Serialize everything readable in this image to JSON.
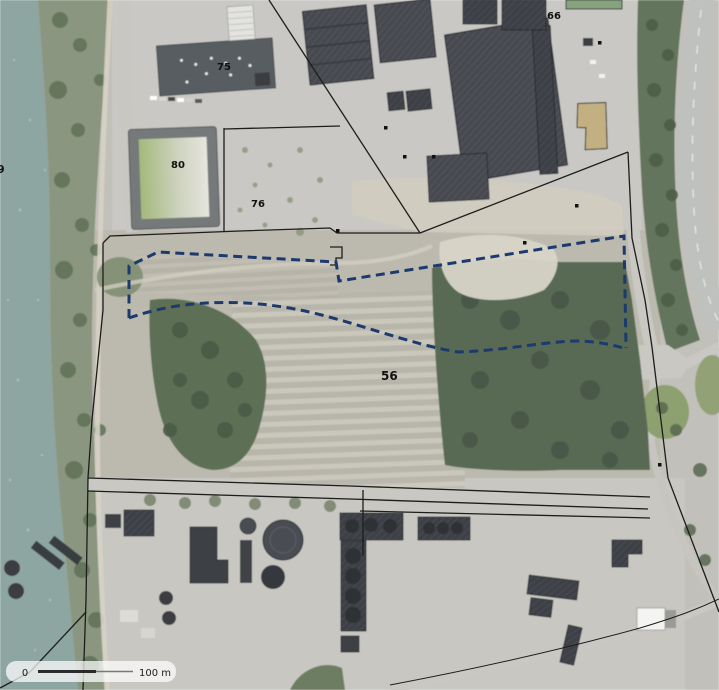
{
  "map": {
    "description": "Aerial orthophoto of an industrial riverside site with cadastral parcel overlay and dashed project boundary",
    "parcel_labels": {
      "p9": "9",
      "p75": "75",
      "p80": "80",
      "p76": "76",
      "p66": "66",
      "p56": "56"
    },
    "scale_bar": {
      "zero": "0",
      "hundred": "100 m"
    },
    "colors": {
      "water": "#8da6a1",
      "bank_vegetation": "#8a9680",
      "forest": "#586b52",
      "ground": "#c2c0ba",
      "parcel56_ground": "#bcb9af",
      "gravel": "#d8d4c8",
      "roof_dark": "#46494f",
      "roof_tan": "#c3b082",
      "roof_green": "#87a27f",
      "cadastral_line": "#1d1d1b",
      "project_boundary": "#1c3a6e",
      "scale_bar_bg": "rgba(255,255,255,0.72)"
    },
    "boundary_style": "dashed"
  }
}
